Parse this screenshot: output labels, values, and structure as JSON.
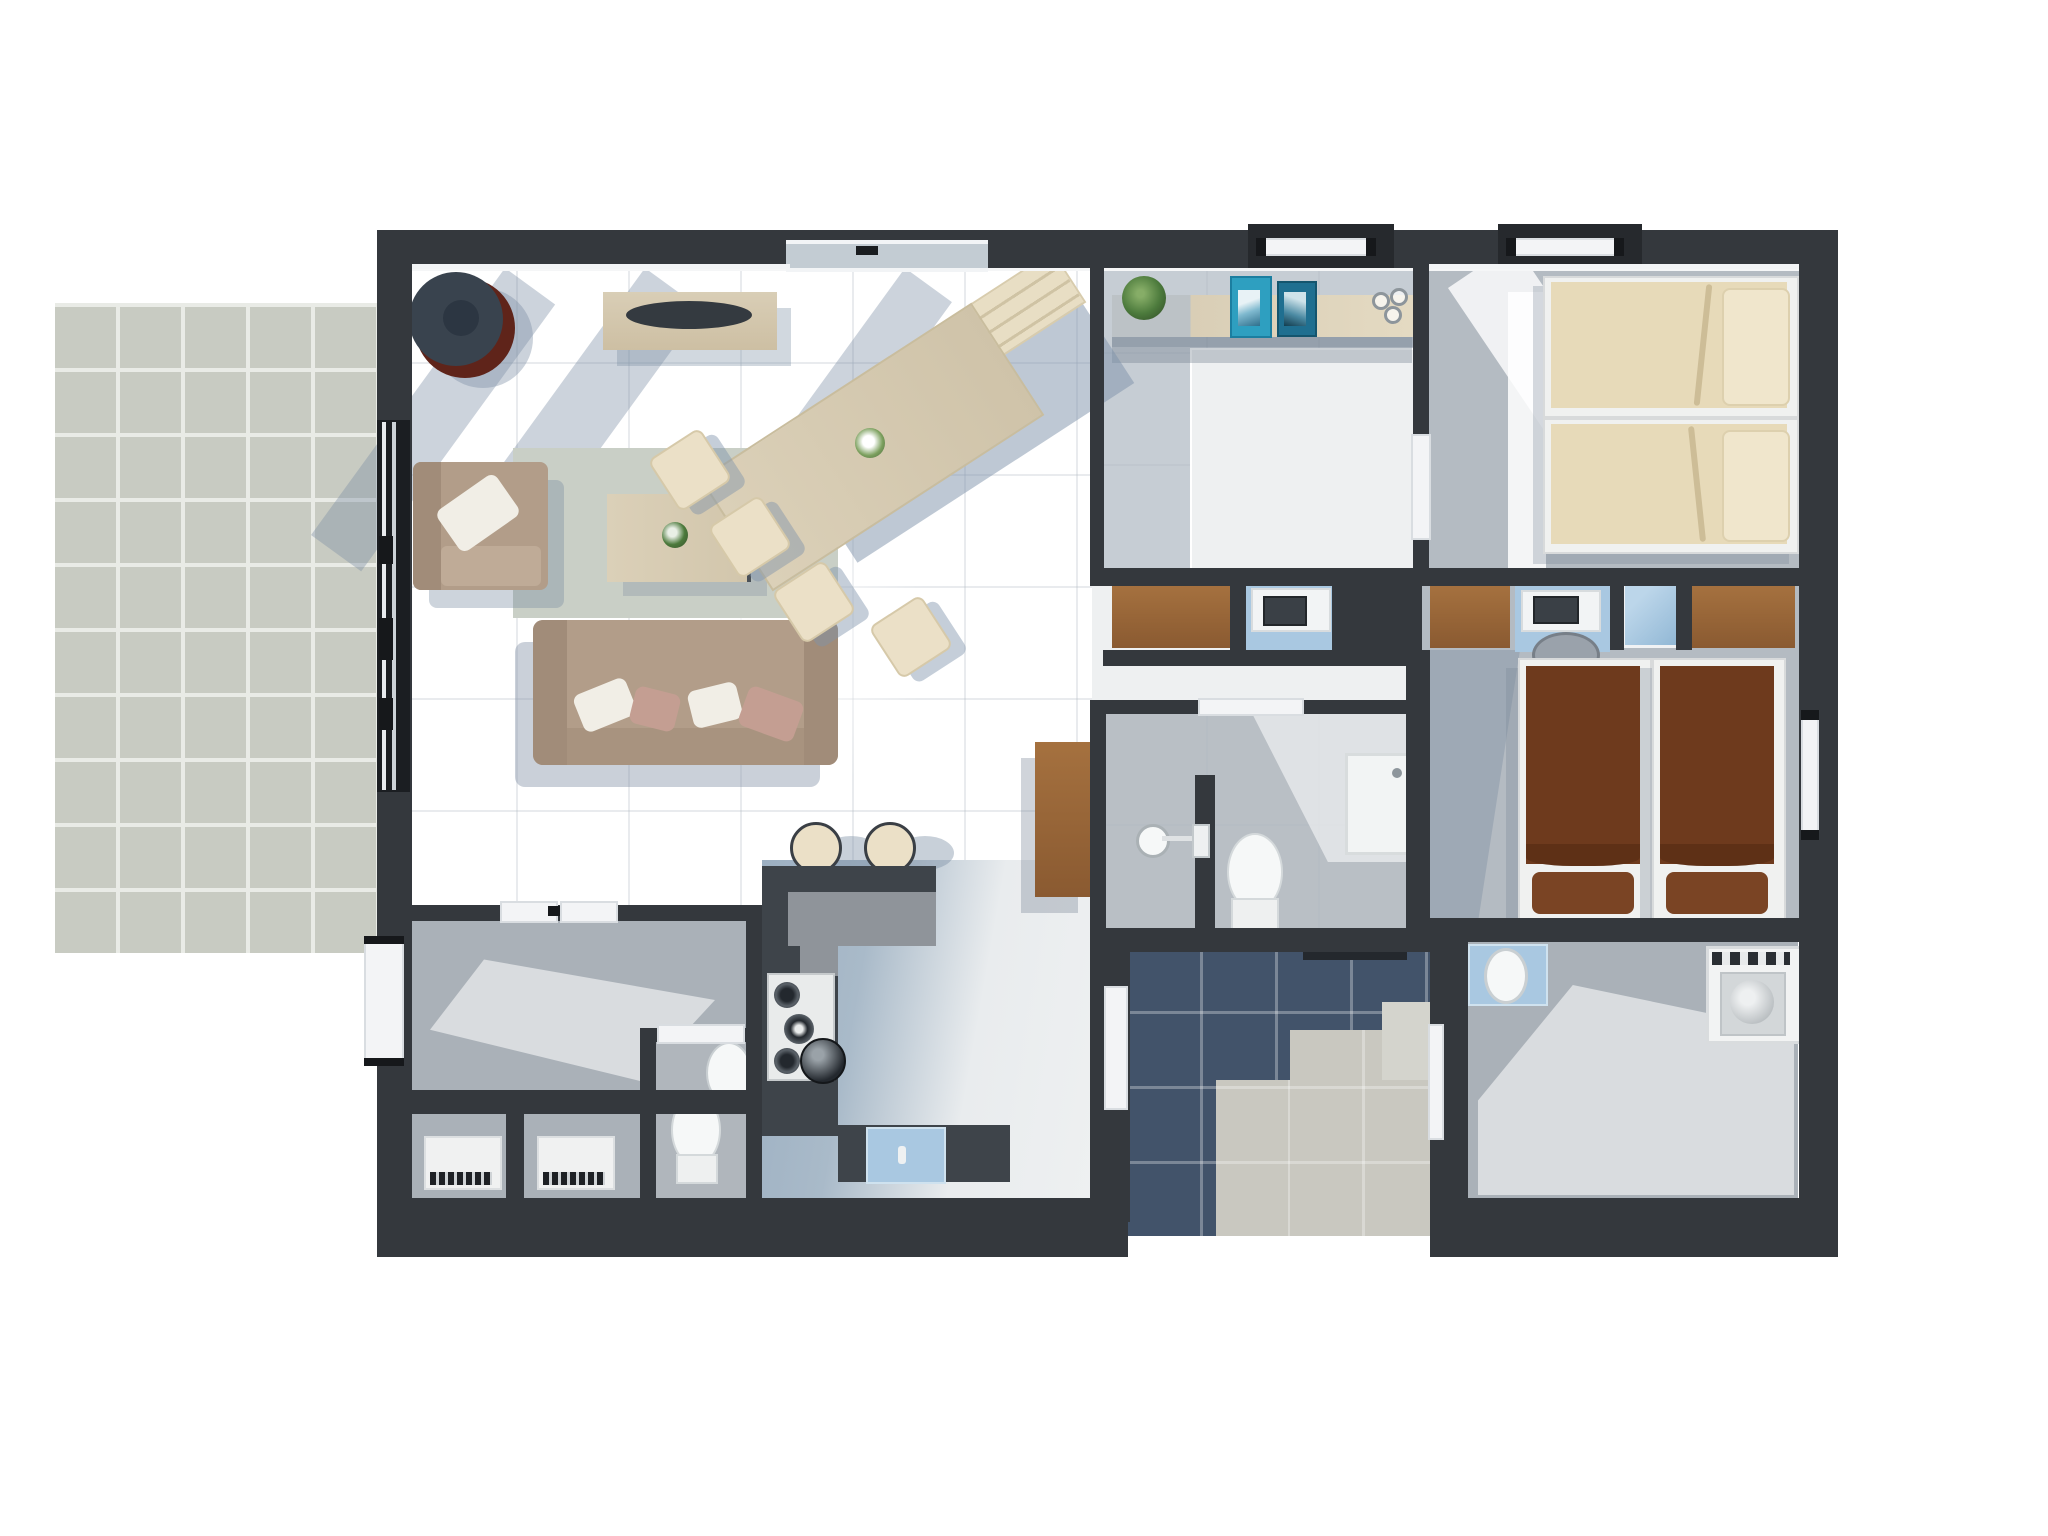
{
  "scene": {
    "kind": "3d-rendered-floor-plan-top-view",
    "background": "#ffffff",
    "has_text": false
  },
  "palette": {
    "wall": "#34383d",
    "wall-dark": "#26292d",
    "floor-white": "#eef0f1",
    "floor-blue": "#8fa4bb",
    "floor-gray": "#aab1b8",
    "bath-gray": "#b9bfc5",
    "bedroom-gray": "#b4bbc2",
    "navy": "#42536a",
    "beige-tile": "#c9c8c0",
    "patio-tile": "#c8cbc2",
    "grout": "#e9ebe6",
    "wood": "#d9ceb6",
    "bench-wood": "#e8dec4",
    "wood-brown": "#a5713f",
    "mattress-beige": "#e7dab9",
    "pillow-beige": "#f0e6cc",
    "mattress-brown": "#6e3a1d",
    "pillow-brown": "#7a4424",
    "sofa-tan": "#b29d89",
    "sofa-dark": "#a18c79",
    "pillow-white": "#f1eee6",
    "pillow-blush": "#c49e92",
    "cream": "#ebe0c7",
    "nook-blue": "#a9c8e1",
    "rug": "#c9cfc6",
    "counter-dark": "#3e444a",
    "counter-face": "#8f949a",
    "fixture": "#f6f8f8",
    "glass": "#c3ccd3",
    "maroon": "#5f241a",
    "charcoal": "#39434e",
    "plant-green": "#4c7a3c",
    "book-blue": "#2e9fc0",
    "book-teal": "#1f6f90"
  },
  "rooms": [
    {
      "name": "patio",
      "floor": "large square tiles",
      "furniture": []
    },
    {
      "name": "living-dining-area",
      "floor": "white with blue-gray light zones",
      "furniture": [
        "round-lounge-chair",
        "sideboard-with-decor-bowl",
        "area-rug",
        "coffee-table-with-plant",
        "armchair-with-pillow",
        "three-seat-sofa-with-four-pillows",
        "rotated-dining-table-with-flower-vase",
        "dining-bench",
        "dining-chair",
        "dining-chair",
        "dining-chair",
        "dining-chair",
        "bar-stool",
        "bar-stool"
      ]
    },
    {
      "name": "kitchen",
      "floor": "blue-gray",
      "furniture": [
        "l-shaped-dark-counter",
        "gas-hob",
        "kettle",
        "sink-with-blue-mat",
        "tall-wood-cabinet"
      ]
    },
    {
      "name": "media-room",
      "floor": "white rug over gray",
      "furniture": [
        "console-shelf",
        "potted-plant",
        "standing-book",
        "standing-book",
        "glassware"
      ]
    },
    {
      "name": "bedroom-top-right",
      "floor": "gray with white runner",
      "furniture": [
        "single-bed-beige",
        "single-bed-beige"
      ]
    },
    {
      "name": "closet-study-band",
      "floor": "mixed",
      "furniture": [
        "wardrobe",
        "desk-nook-with-laptop",
        "wardrobe",
        "desk-nook-with-monitor",
        "blue-niche",
        "wardrobe",
        "office-chair"
      ]
    },
    {
      "name": "bedroom-right",
      "floor": "gray",
      "furniture": [
        "single-bed-brown",
        "single-bed-brown"
      ]
    },
    {
      "name": "bathroom",
      "floor": "gray tile",
      "furniture": [
        "shower-tray",
        "toilet",
        "wall-shower-head",
        "partition-wall",
        "dark-sliding-door"
      ]
    },
    {
      "name": "wc",
      "floor": "gray",
      "furniture": [
        "toilet",
        "wash-basin"
      ]
    },
    {
      "name": "storage-room",
      "floor": "gray",
      "furniture": [
        "closet-mat-with-grate",
        "closet-mat-with-grate"
      ]
    },
    {
      "name": "utility-room",
      "floor": "gray",
      "furniture": [
        "blue-sink-unit",
        "washing-machine"
      ]
    },
    {
      "name": "entry-porch",
      "floor": "navy tiles with beige walkway",
      "furniture": [
        "doormat-door"
      ]
    }
  ],
  "openings": [
    "patio-sliding-glass-door-left-wall",
    "exterior-door-left-wall-lower",
    "window-top-wall-center",
    "exterior-sliding-door-top-wall-1",
    "exterior-sliding-door-top-wall-2",
    "exterior-door-right-wall",
    "interior-door-media-to-bedroom",
    "bathroom-door-top",
    "kitchen-to-porch-door",
    "utility-door",
    "wc-door",
    "storage-doors"
  ]
}
